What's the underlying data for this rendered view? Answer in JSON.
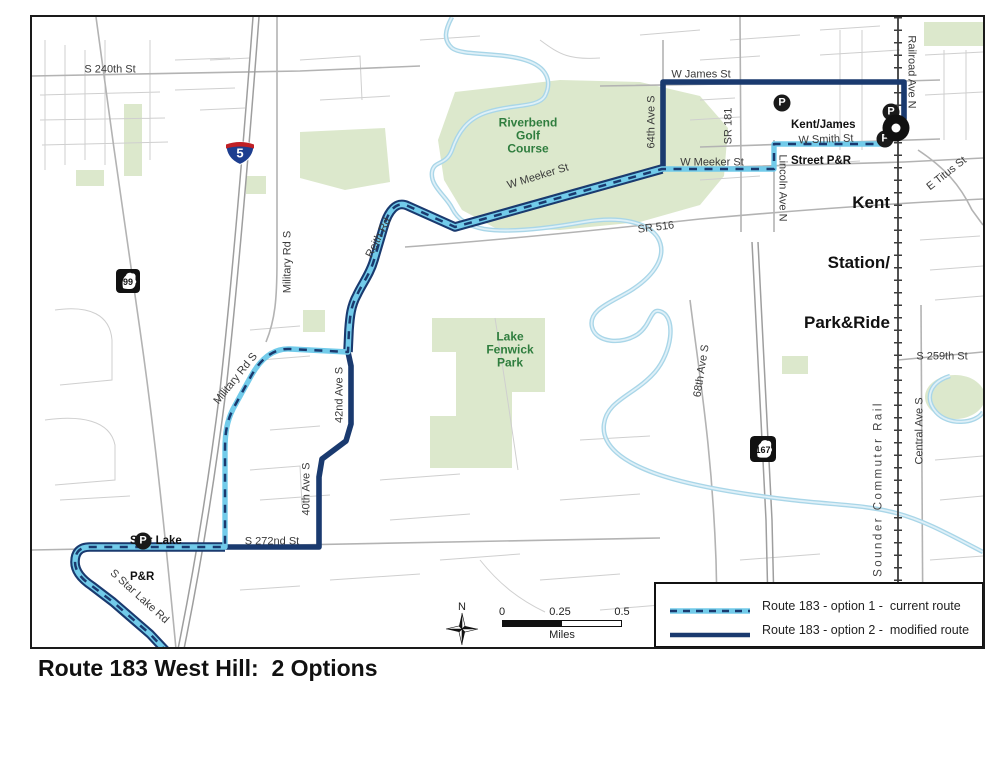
{
  "title": "Route 183 West Hill:  2 Options",
  "colors": {
    "route_option1_light_blue": "#72CBEA",
    "route_option2_navy": "#1A3A6F",
    "park_green_fill": "#DCE8CC",
    "river_blue": "#A9D6E8",
    "green_label_text": "#2F7D3E"
  },
  "legend": {
    "items": [
      {
        "style": "option1-dashed-light-blue",
        "label": "Route 183 - option 1 -  current route"
      },
      {
        "style": "option2-solid-navy",
        "label": "Route 183 - option 2 -  modified route"
      }
    ]
  },
  "scale_bar": {
    "ticks": [
      "0",
      "0.25",
      "0.5"
    ],
    "unit": "Miles"
  },
  "north_label": "N",
  "shields": [
    {
      "type": "interstate",
      "number": "5"
    },
    {
      "type": "wa-state",
      "number": "99"
    },
    {
      "type": "wa-state",
      "number": "167"
    }
  ],
  "poi": {
    "kent_james": {
      "icon": "P",
      "lines": [
        "Kent/James",
        "Street P&R"
      ]
    },
    "kent_station": {
      "icon": "P",
      "lines": [
        "Kent",
        "Station/",
        "Park&Ride"
      ]
    },
    "star_lake": {
      "icon": "P",
      "lines": [
        "Star Lake",
        "P&R"
      ]
    }
  },
  "parks": {
    "riverbend": {
      "lines": "Riverbend\nGolf\nCourse"
    },
    "fenwick": {
      "lines": "Lake\nFenwick\nPark"
    }
  },
  "labels": [
    {
      "text": "S 240th St"
    },
    {
      "text": "W James St"
    },
    {
      "text": "Railroad Ave N"
    },
    {
      "text": "64th Ave S"
    },
    {
      "text": "SR 181"
    },
    {
      "text": "W Smith St"
    },
    {
      "text": "E Titus St"
    },
    {
      "text": "W Meeker St"
    },
    {
      "text": "Lincoln Ave N"
    },
    {
      "text": "W Meeker St"
    },
    {
      "text": "SR 516"
    },
    {
      "text": "Reith Rd"
    },
    {
      "text": "Military Rd S"
    },
    {
      "text": "Military Rd S"
    },
    {
      "text": "42nd Ave S"
    },
    {
      "text": "68th Ave S"
    },
    {
      "text": "S 259th St"
    },
    {
      "text": "Central Ave S"
    },
    {
      "text": "Sounder Commuter Rail"
    },
    {
      "text": "40th Ave S"
    },
    {
      "text": "S 272nd St"
    },
    {
      "text": "S Star Lake Rd"
    }
  ]
}
